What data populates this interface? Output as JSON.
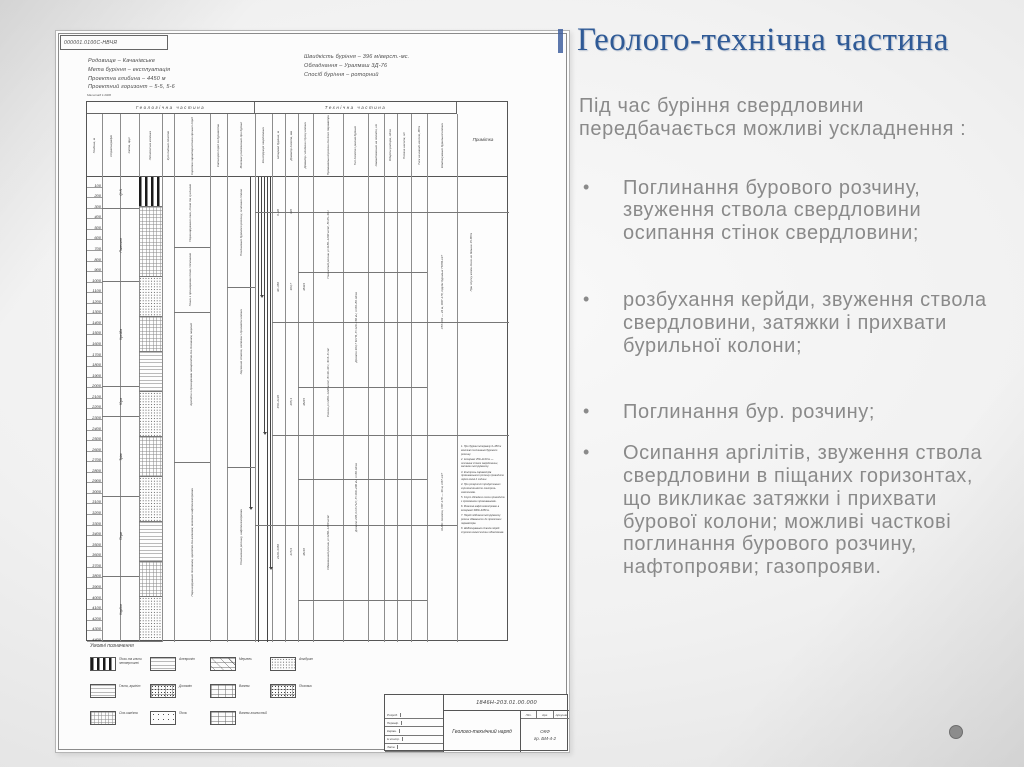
{
  "slide": {
    "title": "Геолого-технічна частина",
    "intro": "Під час буріння свердловини передбачається можливі ускладнення :",
    "bullet_marker": "•",
    "bullets": [
      "Поглинання бурового розчину, звуження ствола свердловини осипання стінок свердловини;",
      "розбухання керйди, звуження ствола свердловини, затяжки і прихвати бурильної колони;",
      "Поглинання бур. розчину;",
      "Осипання аргілітів, звуження ствола свердловини в піщаних горизонтах, що викликає затяжки і прихвати бурової колони; можливі часткові поглинання бурового розчину, нафтопрояви; газопрояви."
    ],
    "accent_color": "#2f5a96",
    "body_text_color": "#8a8a8a"
  },
  "decoration": {
    "dot_color": "#8c8c8c"
  },
  "drawing": {
    "stamp": "000001.0100С-НВЧЯ",
    "scale_note": "Масштаб 1:2000",
    "header_left": [
      "Родовище – Качанівське",
      "Мета буріння – експлуатація",
      "Проектна глибина – 4450 м",
      "Проектний горизонт – 5-5, 5-6"
    ],
    "header_right": [
      "Швидкість буріння – 396 м/верст.-мс.",
      "Обладнання – Уралмаш 3Д-76",
      "Спосіб буріння – роторний"
    ],
    "table": {
      "section_geo": "Геологічна частина",
      "section_tech": "Технічна частина",
      "note_label": "Примітка",
      "columns": [
        {
          "w": 15,
          "sec": "geo",
          "label": "Глибина, м"
        },
        {
          "w": 18,
          "sec": "geo",
          "label": "Стратиграфія"
        },
        {
          "w": 19,
          "sec": "geo",
          "label": "Світа, ярус"
        },
        {
          "w": 23,
          "sec": "geo",
          "label": "Літологічна колонка"
        },
        {
          "w": 12,
          "sec": "geo",
          "label": "Кут падіння пластів"
        },
        {
          "w": 36,
          "sec": "geo",
          "label": "Коротка характеристика гірських порід"
        },
        {
          "w": 17,
          "sec": "geo",
          "label": "Категорія порід за буримістю"
        },
        {
          "w": 28,
          "sec": "geo",
          "label": "Можливі ускладнення при бурінні"
        },
        {
          "w": 17,
          "sec": "tech",
          "label": "Конструкція свердловини"
        },
        {
          "w": 13,
          "sec": "tech",
          "label": "Інтервал буріння, м"
        },
        {
          "w": 13,
          "sec": "tech",
          "label": "Діаметр долота, мм"
        },
        {
          "w": 15,
          "sec": "tech",
          "label": "Діаметр і глибина спуску колони"
        },
        {
          "w": 30,
          "sec": "tech",
          "label": "Промивальний розчин та його параметри"
        },
        {
          "w": 25,
          "sec": "tech",
          "label": "Тип долота і режим буріння"
        },
        {
          "w": 16,
          "sec": "tech",
          "label": "Навантаження на долото, кН"
        },
        {
          "w": 13,
          "sec": "tech",
          "label": "Оберти ротора, об/хв"
        },
        {
          "w": 14,
          "sec": "tech",
          "label": "Подача насосів, л/с"
        },
        {
          "w": 16,
          "sec": "tech",
          "label": "Тиск на викиді насосів, МПа"
        },
        {
          "w": 30,
          "sec": "tech",
          "label": "Компонування бурильної колони"
        },
        {
          "w": 52,
          "sec": "note",
          "label": "Примітка"
        }
      ]
    },
    "body": {
      "depth": {
        "start": 100,
        "end": 4400,
        "step": 100
      },
      "strat_segments": [
        {
          "h": 32,
          "label": "Q+N"
        },
        {
          "h": 73,
          "label": "Палеоген"
        },
        {
          "h": 105,
          "label": "Крейда"
        },
        {
          "h": 30,
          "label": "Юра"
        },
        {
          "h": 80,
          "label": "Тріас"
        },
        {
          "h": 80,
          "label": "Перм"
        },
        {
          "h": 65,
          "label": "Карбон"
        }
      ],
      "litho_segments": [
        {
          "h": 30,
          "p": "piano"
        },
        {
          "h": 70,
          "p": "grid"
        },
        {
          "h": 40,
          "p": "dots"
        },
        {
          "h": 35,
          "p": "grid"
        },
        {
          "h": 40,
          "p": "hlines"
        },
        {
          "h": 45,
          "p": "dots"
        },
        {
          "h": 40,
          "p": "grid"
        },
        {
          "h": 45,
          "p": "dots"
        },
        {
          "h": 40,
          "p": "hlines"
        },
        {
          "h": 35,
          "p": "grid"
        },
        {
          "h": 45,
          "p": "dots"
        }
      ],
      "casing_lines": [
        {
          "x": 163,
          "h": 330,
          "arrow": true
        },
        {
          "x": 171,
          "h": 465,
          "arrow": false
        },
        {
          "x": 174,
          "h": 118,
          "arrow": true
        },
        {
          "x": 177,
          "h": 255,
          "arrow": true
        },
        {
          "x": 180,
          "h": 465,
          "arrow": false
        },
        {
          "x": 183,
          "h": 390,
          "arrow": true
        }
      ],
      "dividers": [
        {
          "x1": 168,
          "x2": 422,
          "y": 35
        },
        {
          "x1": 211,
          "x2": 340,
          "y": 95
        },
        {
          "x1": 185,
          "x2": 422,
          "y": 145
        },
        {
          "x1": 211,
          "x2": 340,
          "y": 210
        },
        {
          "x1": 185,
          "x2": 422,
          "y": 258
        },
        {
          "x1": 211,
          "x2": 340,
          "y": 302
        },
        {
          "x1": 168,
          "x2": 370,
          "y": 348
        },
        {
          "x1": 211,
          "x2": 340,
          "y": 423
        },
        {
          "x1": 87,
          "x2": 123,
          "y": 70
        },
        {
          "x1": 87,
          "x2": 123,
          "y": 135
        },
        {
          "x1": 87,
          "x2": 123,
          "y": 285
        },
        {
          "x1": 140,
          "x2": 168,
          "y": 110
        },
        {
          "x1": 140,
          "x2": 168,
          "y": 290
        }
      ],
      "interval_labels": [
        {
          "x": 186,
          "y": 10,
          "h": 50,
          "t": "0–30"
        },
        {
          "x": 186,
          "y": 75,
          "h": 70,
          "t": "30–450"
        },
        {
          "x": 186,
          "y": 180,
          "h": 90,
          "t": "450–2120"
        },
        {
          "x": 186,
          "y": 320,
          "h": 110,
          "t": "2120–4450"
        },
        {
          "x": 199,
          "y": 10,
          "h": 50,
          "t": "426"
        },
        {
          "x": 199,
          "y": 75,
          "h": 70,
          "t": "393,7"
        },
        {
          "x": 199,
          "y": 180,
          "h": 90,
          "t": "295,3"
        },
        {
          "x": 199,
          "y": 320,
          "h": 110,
          "t": "215,9"
        },
        {
          "x": 212,
          "y": 75,
          "h": 70,
          "t": "Ø324"
        },
        {
          "x": 212,
          "y": 180,
          "h": 90,
          "t": "Ø245"
        },
        {
          "x": 212,
          "y": 320,
          "h": 110,
          "t": "Ø146"
        }
      ],
      "text_blocks": [
        {
          "x": 89,
          "y": 5,
          "w": 28,
          "h": 62,
          "t": "Перешарування глин, пісків та суглинків"
        },
        {
          "x": 89,
          "y": 75,
          "w": 28,
          "h": 55,
          "t": "Глини з прошарками пісків і пісковиків"
        },
        {
          "x": 89,
          "y": 140,
          "w": 30,
          "h": 95,
          "t": "Аргіліти з прошарками алевролітів та пісковиків, мергелі"
        },
        {
          "x": 89,
          "y": 290,
          "w": 32,
          "h": 150,
          "t": "Перешарування пісковиків, аргілітів та вапняків; можливі нафтогазопрояви"
        },
        {
          "x": 142,
          "y": 10,
          "w": 24,
          "h": 70,
          "t": "Поглинання бурового розчину, осипання стінок"
        },
        {
          "x": 142,
          "y": 120,
          "w": 24,
          "h": 90,
          "t": "Звуження ствола, затяжки і прихвати колони"
        },
        {
          "x": 142,
          "y": 300,
          "w": 24,
          "h": 120,
          "t": "Поглинання розчину, нафтогазопрояви"
        },
        {
          "x": 228,
          "y": 25,
          "w": 26,
          "h": 85,
          "t": "Глинистий розчин ρ=1180–1200 кг/м³, В=25–30 с"
        },
        {
          "x": 228,
          "y": 150,
          "w": 26,
          "h": 110,
          "t": "Розчин ρ=1200–1220 кг/м³, В=30–40 с, Ф=6–8 см³"
        },
        {
          "x": 228,
          "y": 300,
          "w": 26,
          "h": 130,
          "t": "Обважнений розчин ρ=1260–1280 кг/м³"
        },
        {
          "x": 258,
          "y": 90,
          "w": 22,
          "h": 120,
          "t": "Долото 393,7 М-ГВ, Р=120–160 кН, n=60–80 об/хв"
        },
        {
          "x": 258,
          "y": 250,
          "w": 22,
          "h": 140,
          "t": "Долото 295,3 СЗ-ГНУ, Р=160–200 кН, n=60 об/хв"
        },
        {
          "x": 342,
          "y": 40,
          "w": 26,
          "h": 150,
          "t": "УБТ-203 — 24 м, ОБТ-178, труби бурильні ТБПВ-127"
        },
        {
          "x": 342,
          "y": 240,
          "w": 26,
          "h": 170,
          "t": "КНБК: долото, УБТ-178 — 36 м, СБТ-127"
        },
        {
          "x": 374,
          "y": 15,
          "w": 20,
          "h": 140,
          "t": "При спуску колон тиск не більше 15 МПа"
        }
      ],
      "notes_lines": [
        "1. При бурінні інтервалу 0–450 м можливі поглинання бурового розчину.",
        "2. Інтервал 450–2120 м — осипання стінок свердловини, затяжки інструменту.",
        "3. Контроль параметрів промивального розчину проводити через кожні 2 години.",
        "4. При розкритті продуктивних горизонтів вести контроль газопоказів.",
        "5. Спуск обсадних колон проводити з проміжними промиваннями.",
        "6. Можливі нафтогазопрояви в інтервалі 3900–4450 м.",
        "7. Перед підйомом інструменту розчин обважнити до проектних параметрів.",
        "8. Шаблонування ствола перед спуском кожної колони обов'язкове."
      ]
    },
    "legend": {
      "title": "Умовні позначення",
      "items": [
        {
          "p": "piano",
          "label": "Піски та глини четвертинні"
        },
        {
          "p": "hlines",
          "label": "Алевроліт"
        },
        {
          "p": "brickdash",
          "label": "Мергель"
        },
        {
          "p": "dots",
          "label": "Ангідрит"
        },
        {
          "p": "hlines",
          "label": "Глина, аргіліт"
        },
        {
          "p": "brickdots",
          "label": "Доломіт"
        },
        {
          "p": "brick",
          "label": "Вапняк"
        },
        {
          "p": "brickdots",
          "label": "Пісковик"
        },
        {
          "p": "grid",
          "label": "Сіль кам'яна"
        },
        {
          "p": "dotssp",
          "label": "Пісок"
        },
        {
          "p": "brick",
          "label": "Вапняк глинистий"
        }
      ]
    },
    "titleblock": {
      "doc_number": "1846Н-203.01.00.000",
      "title": "Геолого-технічний наряд",
      "left_rows": [
        "Розроб.",
        "Перевір.",
        "Керівн.",
        "Н.контр.",
        "Затв."
      ],
      "lit_labels": [
        "Літ.",
        "Арк.",
        "Аркушів"
      ],
      "org": "ОКФ",
      "group": "гр. БМ-4-2"
    }
  }
}
